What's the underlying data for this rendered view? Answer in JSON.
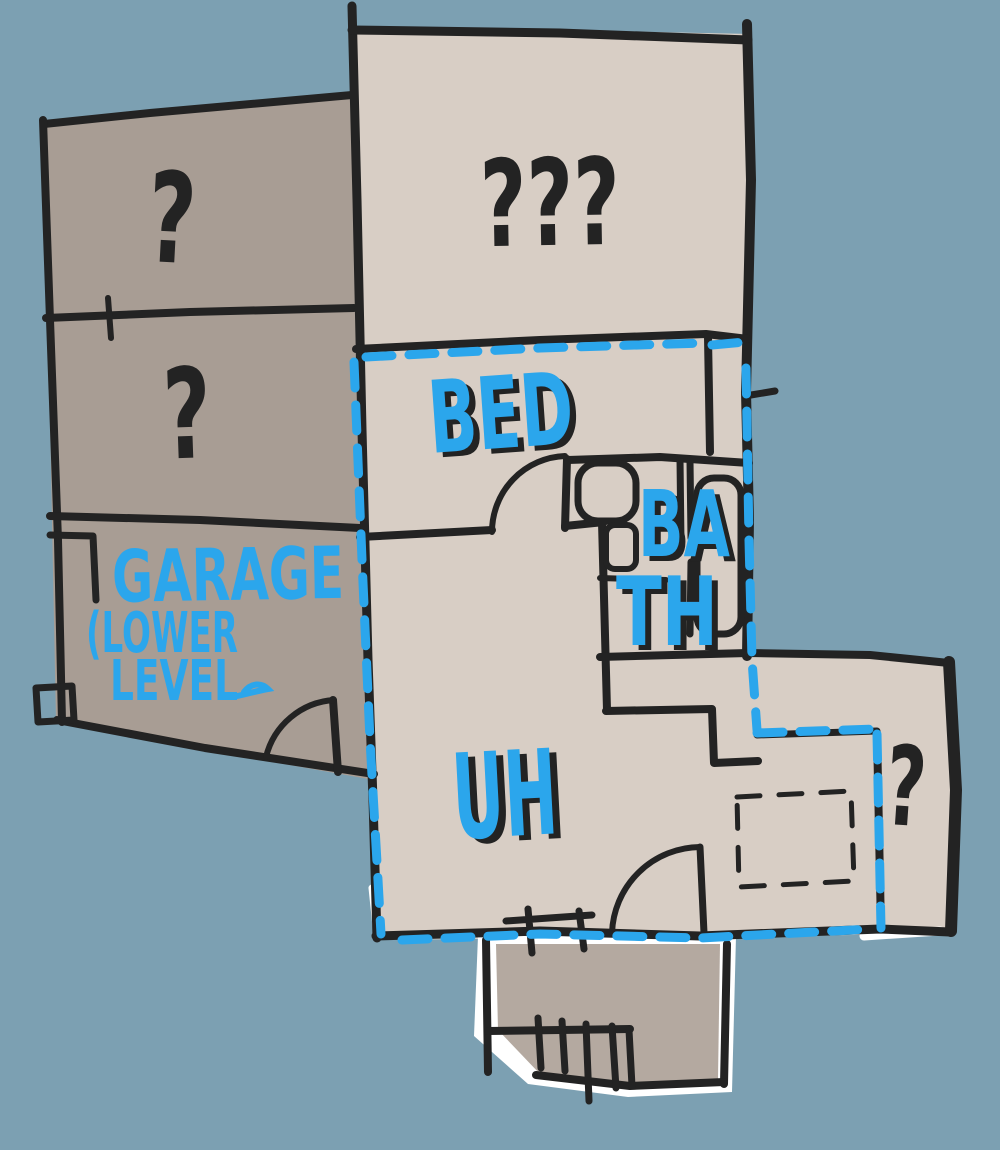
{
  "title": "hand-drawn floor plan sketch",
  "colors": {
    "background": "#7CA0B2",
    "ink": "#232323",
    "marker_blue": "#2BA6EC",
    "fill_left_wing": "#A89D94",
    "fill_main": "#D8CEC5",
    "fill_lower_room": "#B4A9A0",
    "paper": "#FFFFFF"
  },
  "labels": {
    "upper_left_room": "?",
    "mid_left_room": "?",
    "garage_line1": "GARAGE",
    "garage_line2": "(LOWER",
    "garage_line3": "LEVEL",
    "top_room": "???",
    "bedroom": "BED",
    "bathroom_line1": "BA",
    "bathroom_line2": "TH",
    "hall_room": "UH",
    "right_room": "?"
  }
}
